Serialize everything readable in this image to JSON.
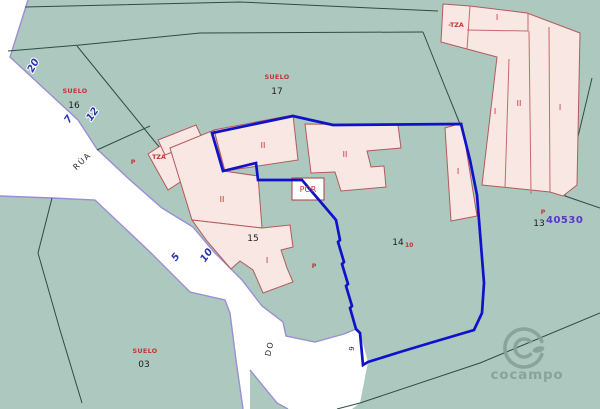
{
  "map": {
    "colors": {
      "background": "#adc8bf",
      "road_fill": "#ffffff",
      "road_edge": "#9a8fd2",
      "parcel_line": "#2b4f3f",
      "building_fill": "#f8e7e3",
      "building_stroke": "#b25b5b",
      "focus_boundary": "#0f11cb",
      "label_red": "#c23434",
      "label_black": "#1d1d1d",
      "road_number_blue": "#2b37b0",
      "reference_violet": "#5b35cc",
      "watermark": "#87a098"
    },
    "parcels": [
      {
        "id": "16",
        "type_label": "SUELO"
      },
      {
        "id": "17",
        "type_label": "SUELO"
      },
      {
        "id": "03",
        "type_label": "SUELO"
      },
      {
        "id": "15"
      },
      {
        "id": "14",
        "sub": "10"
      },
      {
        "id": "13",
        "marker": "P"
      }
    ],
    "reference": "40530",
    "road": {
      "name": "RÚA",
      "name2": "DO",
      "number_9": "9",
      "width_labels": [
        "20",
        "7",
        "12",
        "5",
        "10"
      ]
    },
    "buildings": {
      "floor_one": "I",
      "floor_two": "II",
      "terrace": "TZA",
      "terrace_minus": "-TZA",
      "porch": "POR",
      "marker": "P"
    },
    "watermark": {
      "name": "cocampo"
    }
  }
}
